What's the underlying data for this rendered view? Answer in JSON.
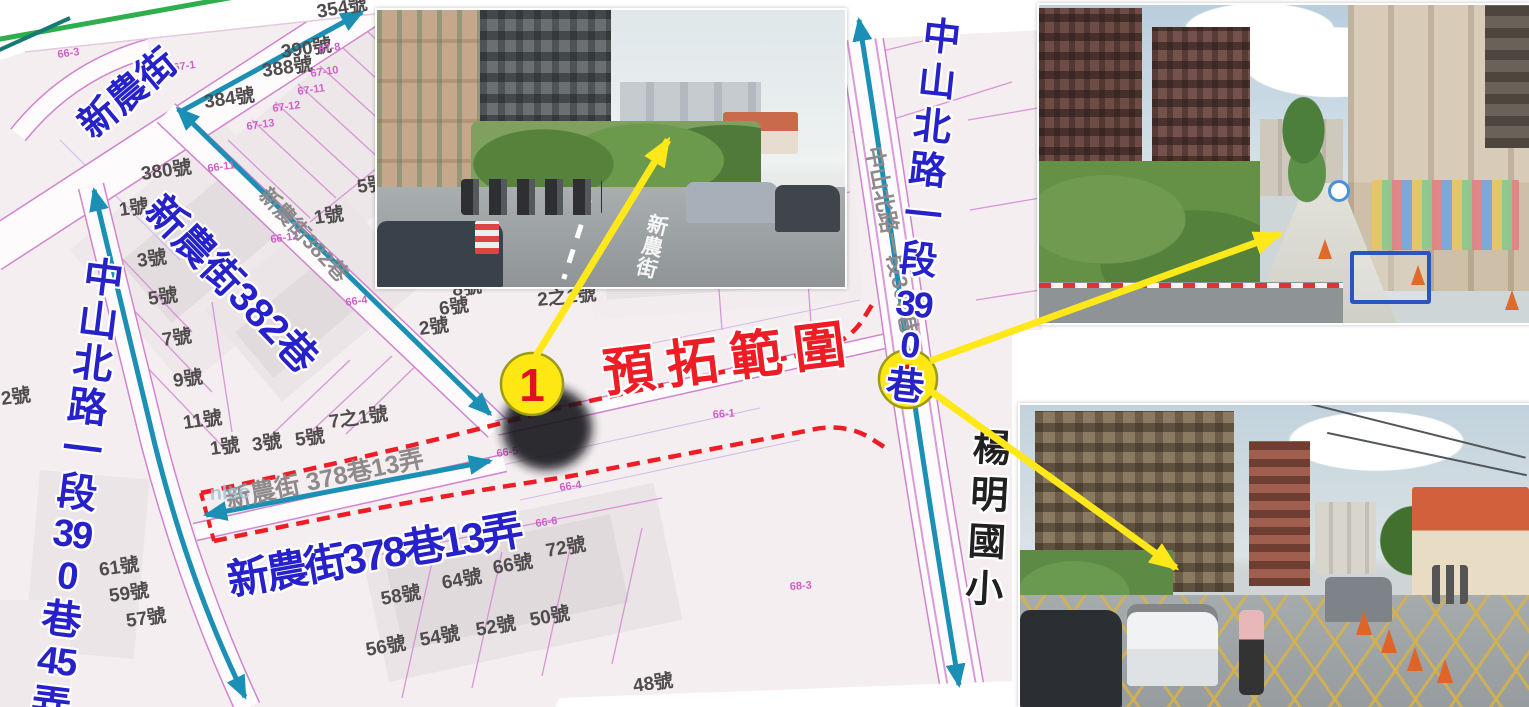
{
  "title": "road widening plan map",
  "colors": {
    "label_blue": "#2621c9",
    "annotation_red": "#ee1c25",
    "arrow_teal": "#1b8fb4",
    "arrow_yellow": "#ffe81a",
    "marker_fill": "#ffe713",
    "marker_number_red": "#e0121d",
    "parcel_line_pink": "#d184cf",
    "map_bg": "#f4eef0"
  },
  "labels": {
    "xinnong_street": "新農街",
    "xinnong_382": "新農街382巷",
    "xinnong_378_13": "新農街378巷13弄",
    "expansion_zone": "預拓範圍",
    "left_road": {
      "part1": "中山北路一段",
      "num1": "390",
      "part2": "巷",
      "num2": "45",
      "part3": "弄"
    },
    "right_road": {
      "part1": "中山北路一段",
      "num1": "390",
      "part2": "巷"
    },
    "school": "楊明國小"
  },
  "markers": [
    {
      "label": "1"
    },
    {
      "label": "2"
    }
  ],
  "photos": {
    "photo1": {
      "road_text": "新農街"
    }
  },
  "map": {
    "house_numbers": [
      {
        "text": "354號",
        "x": 318,
        "y": 18,
        "rot": -10
      },
      {
        "text": "390號",
        "x": 282,
        "y": 58,
        "rot": -8
      },
      {
        "text": "388號",
        "x": 263,
        "y": 77,
        "rot": -8
      },
      {
        "text": "384號",
        "x": 205,
        "y": 108,
        "rot": -8
      },
      {
        "text": "380號",
        "x": 142,
        "y": 180,
        "rot": -8
      },
      {
        "text": "1號",
        "x": 120,
        "y": 216,
        "rot": -8
      },
      {
        "text": "3號",
        "x": 138,
        "y": 267,
        "rot": -8
      },
      {
        "text": "5號",
        "x": 149,
        "y": 305,
        "rot": -8
      },
      {
        "text": "7號",
        "x": 163,
        "y": 346,
        "rot": -8
      },
      {
        "text": "9號",
        "x": 174,
        "y": 387,
        "rot": -8
      },
      {
        "text": "11號",
        "x": 184,
        "y": 429,
        "rot": -8
      },
      {
        "text": "1號",
        "x": 211,
        "y": 455,
        "rot": -8
      },
      {
        "text": "3號",
        "x": 253,
        "y": 451,
        "rot": -8
      },
      {
        "text": "5號",
        "x": 296,
        "y": 446,
        "rot": -8
      },
      {
        "text": "1號",
        "x": 315,
        "y": 224,
        "rot": -8
      },
      {
        "text": "5號",
        "x": 358,
        "y": 193,
        "rot": -8
      },
      {
        "text": "2號",
        "x": 2,
        "y": 405,
        "rot": -8
      },
      {
        "text": "7之1號",
        "x": 330,
        "y": 428,
        "rot": -8
      },
      {
        "text": "2號",
        "x": 420,
        "y": 335,
        "rot": -8
      },
      {
        "text": "6號",
        "x": 440,
        "y": 315,
        "rot": -8
      },
      {
        "text": "8號",
        "x": 453,
        "y": 296,
        "rot": -8
      },
      {
        "text": "2之1號",
        "x": 538,
        "y": 306,
        "rot": -6
      },
      {
        "text": "61號",
        "x": 100,
        "y": 576,
        "rot": -8
      },
      {
        "text": "59號",
        "x": 110,
        "y": 602,
        "rot": -8
      },
      {
        "text": "57號",
        "x": 127,
        "y": 627,
        "rot": -8
      },
      {
        "text": "58號",
        "x": 382,
        "y": 605,
        "rot": -10
      },
      {
        "text": "64號",
        "x": 443,
        "y": 589,
        "rot": -10
      },
      {
        "text": "66號",
        "x": 494,
        "y": 574,
        "rot": -10
      },
      {
        "text": "72號",
        "x": 547,
        "y": 557,
        "rot": -10
      },
      {
        "text": "56號",
        "x": 367,
        "y": 656,
        "rot": -10
      },
      {
        "text": "54號",
        "x": 421,
        "y": 646,
        "rot": -10
      },
      {
        "text": "52號",
        "x": 477,
        "y": 636,
        "rot": -10
      },
      {
        "text": "50號",
        "x": 531,
        "y": 626,
        "rot": -10
      },
      {
        "text": "48號",
        "x": 634,
        "y": 692,
        "rot": -8
      }
    ],
    "parcel_codes": [
      {
        "text": "66-3",
        "x": 58,
        "y": 58,
        "rot": -8
      },
      {
        "text": "67-1",
        "x": 174,
        "y": 71,
        "rot": -8
      },
      {
        "text": "67-8",
        "x": 319,
        "y": 53,
        "rot": -8
      },
      {
        "text": "67-10",
        "x": 311,
        "y": 77,
        "rot": -8
      },
      {
        "text": "67-11",
        "x": 298,
        "y": 95,
        "rot": -8
      },
      {
        "text": "67-12",
        "x": 273,
        "y": 112,
        "rot": -8
      },
      {
        "text": "67-13",
        "x": 247,
        "y": 130,
        "rot": -8
      },
      {
        "text": "66-11",
        "x": 208,
        "y": 172,
        "rot": -8
      },
      {
        "text": "66-12",
        "x": 271,
        "y": 243,
        "rot": -8
      },
      {
        "text": "66-4",
        "x": 346,
        "y": 306,
        "rot": -8
      },
      {
        "text": "66-4",
        "x": 560,
        "y": 491,
        "rot": -8
      },
      {
        "text": "66-6",
        "x": 536,
        "y": 527,
        "rot": -8
      },
      {
        "text": "66-5",
        "x": 497,
        "y": 457,
        "rot": -8
      },
      {
        "text": "66-1",
        "x": 713,
        "y": 418,
        "rot": -4
      },
      {
        "text": "68-3",
        "x": 790,
        "y": 590,
        "rot": -4
      }
    ],
    "street_names": [
      {
        "text": "新農街382巷",
        "x": 258,
        "y": 196,
        "rot": 47,
        "size": 21
      },
      {
        "text": "新農街 378巷13弄",
        "x": 228,
        "y": 508,
        "rot": -12,
        "size": 25
      },
      {
        "text": "中山北路一段390巷",
        "x": 866,
        "y": 148,
        "rot": 79,
        "size": 22
      }
    ],
    "watermarks": [
      {
        "text": "nlsc",
        "x": 210,
        "y": 500,
        "rot": -3,
        "size": 20
      }
    ]
  }
}
